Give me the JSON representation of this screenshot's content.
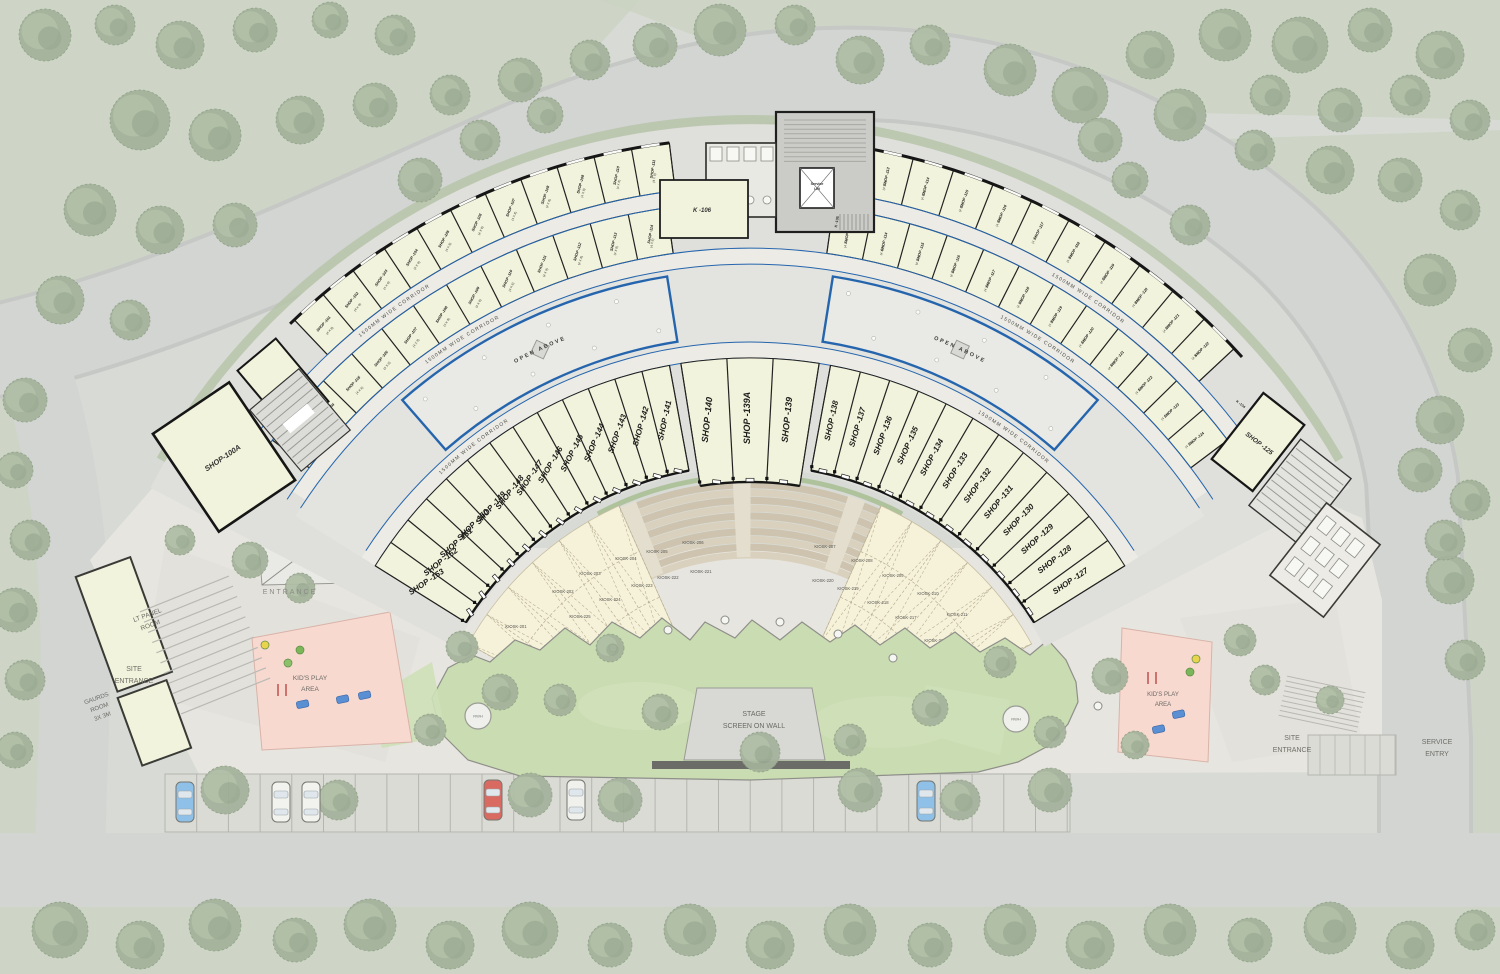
{
  "colors": {
    "background": "#d8dbd5",
    "green_belt": "#c9d2c0",
    "tree": "#a4b29b",
    "road": "#d3d5d3",
    "plaza": "#e7e5df",
    "shop_fill": "#f2f3dc",
    "wall": "#1f1f1f",
    "corridor_blue": "#2565ad",
    "amphitheater_step": "#d4cab6",
    "lawn": "#cadcb2",
    "kiosk_paving": "#f6f2da",
    "kids_play_pink": "#f8d9d0",
    "stage_gray": "#d8d8d5",
    "parking": "#dbdbd6"
  },
  "building": {
    "corridor_label": "1500MM WIDE CORRIDOR",
    "open_above_label": "OPEN ABOVE",
    "small_shop_size": "(4 X 8)",
    "service_lift_lines": [
      "Service",
      "Lift"
    ],
    "room_k106": "K -106",
    "room_k105": "K -105",
    "room_k104": "K -104",
    "shop_100": "SHOP -100",
    "shop_100a": "SHOP-100A",
    "shop_125": "SHOP -125",
    "inner_left": [
      "SHOP -153",
      "SHOP -152",
      "SHOP -151",
      "SHOP -150",
      "SHOP -149",
      "SHOP -148",
      "SHOP -147",
      "SHOP -146",
      "SHOP -145",
      "SHOP -144",
      "SHOP -143",
      "SHOP -142",
      "SHOP -141"
    ],
    "inner_center": [
      "SHOP -140",
      "SHOP -139A",
      "SHOP -139"
    ],
    "inner_right": [
      "SHOP -138",
      "SHOP -137",
      "SHOP -136",
      "SHOP -135",
      "SHOP -134",
      "SHOP -133",
      "SHOP -132",
      "SHOP -131",
      "SHOP -130",
      "SHOP -129",
      "SHOP -128",
      "SHOP -127"
    ],
    "row_a_left": [
      "SHOP -101",
      "SHOP -102",
      "SHOP -103",
      "SHOP -104",
      "SHOP -105",
      "SHOP -106",
      "SHOP -107",
      "SHOP -108",
      "SHOP -109",
      "SHOP -110",
      "SHOP -111"
    ],
    "row_a_right": [
      "SHOP -112",
      "SHOP -113",
      "SHOP -114",
      "SHOP -115",
      "SHOP -116",
      "SHOP -117",
      "SHOP -118",
      "SHOP -119",
      "SHOP -120",
      "SHOP -121",
      "SHOP -122"
    ],
    "row_b_left": [
      "SHOP -103",
      "SHOP -104",
      "SHOP -105",
      "SHOP -106",
      "SHOP -107",
      "SHOP -108",
      "SHOP -109",
      "SHOP -110",
      "SHOP -111",
      "SHOP -112",
      "SHOP -113",
      "SHOP -114"
    ],
    "row_b_right": [
      "SHOP -113",
      "SHOP -114",
      "SHOP -115",
      "SHOP -116",
      "SHOP -117",
      "SHOP -118",
      "SHOP -119",
      "SHOP -120",
      "SHOP -121",
      "SHOP -122",
      "SHOP -123",
      "SHOP -124"
    ]
  },
  "kiosks": {
    "left": [
      "KIOSK-201",
      "KIOSK-202",
      "KIOSK-203",
      "KIOSK-204",
      "KIOSK-205",
      "KIOSK-206",
      "KIOSK-221",
      "KIOSK-222",
      "KIOSK-223",
      "KIOSK-224",
      "KIOSK-225",
      "KIOSK-226",
      "KIOSK-227",
      "KIOSK-228"
    ],
    "right": [
      "KIOSK-207",
      "KIOSK-208",
      "KIOSK-209",
      "KIOSK-210",
      "KIOSK-211",
      "KIOSK-212",
      "KIOSK-213-14",
      "KIOSK-215",
      "KIOSK-216",
      "KIOSK-217",
      "KIOSK-218",
      "KIOSK-219",
      "KIOSK-220"
    ]
  },
  "site": {
    "entrance": "ENTRANCE",
    "site_entrance_lines": [
      "SITE",
      "ENTRANCE"
    ],
    "site_entrance_right_lines": [
      "SITE",
      "ENTRANCE"
    ],
    "service_entry_lines": [
      "SERVICE",
      "ENTRY"
    ],
    "lt_panel_lines": [
      "LT PANEL",
      "ROOM"
    ],
    "guards_lines": [
      "GAURDS",
      "ROOM",
      "3X 3M"
    ],
    "kids_play_lines": [
      "KID'S PLAY",
      "AREA"
    ],
    "stage_lines": [
      "STAGE",
      "SCREEN ON WALL"
    ],
    "rwh": "RWH"
  }
}
